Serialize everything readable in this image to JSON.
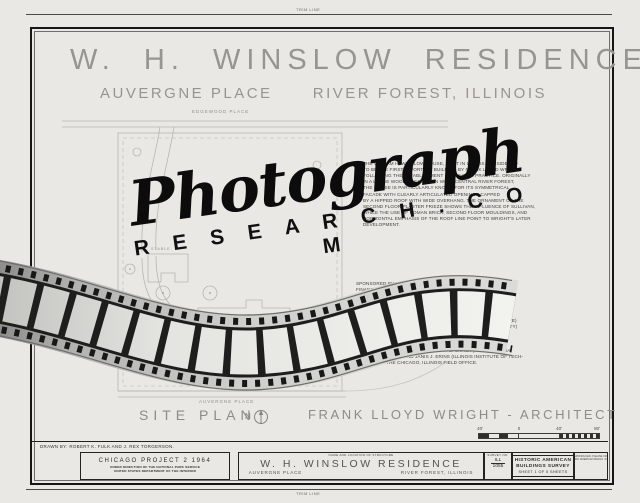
{
  "trim": {
    "top_label": "TRIM LINE",
    "bottom_label": "TRIM LINE"
  },
  "title": {
    "main": "W. H. WINSLOW RESIDENCE",
    "sub_left": "AUVERGNE PLACE",
    "sub_right": "RIVER FOREST, ILLINOIS"
  },
  "plan": {
    "street_top": "EDGEWOOD PLACE",
    "street_bottom": "AUVERGNE PLACE",
    "stable_label": "STABLE"
  },
  "paragraphs": {
    "history": "THE WILLIAM H. WINSLOW HOUSE, BUILT IN 1893, IS CONSIDERED\nTO BE THE FIRST IMPORTANT BUILDING BY FRANK LLOYD WRIGHT\nFOLLOWING THE ESTABLISHMENT OF HIS OWN PRACTICE. ORIGINALLY\nIN A LARGE WOODED ESTATE IN WEST CENTRAL RIVER FOREST,\nTHE HOUSE IS PARTICULARLY KNOWN FOR ITS SYMMETRICAL\nFACADE WITH CLEARLY ARTICULATED OPENINGS CAPPED\nBY A HIPPED ROOF WITH WIDE OVERHANG. THE ORNAMENT OF THE\nSECOND FLOOR PLASTER FRIEZE SHOWS THE INFLUENCE OF SULLIVAN,\nWHILE THE USE OF ROMAN BRICK, SECOND FLOOR MOULDINGS, AND\nHORIZONTAL EMPHASIS OF THE ROOF LINE POINT TO WRIGHT'S LATER\nDEVELOPMENT.",
    "credits": "SPONSORED BY THE NATIONAL PARK SERVICE, THE PROJECT WAS\nFINANCED FROM THE FUNDS OF THE \"MISSION 66\" PROGRAM\nOF THE NATIONAL PARK SERVICE AND FROM FUNDS LOCALLY DO-\nNATED. IT WAS MEASURED AND DRAWN DURING THE SUMMER OF\n1964 UNDER THE DIRECTION OF JAMES C. MASSEY, H.A.B.S.\nSUPERVISORY ARCHITECT, AND EARL H. REED, F.A.I.A., PROJECT\nSPONSOR, BY J. WILLIAM RUDD (TEXAS TECHNOLOGICAL COLLEGE)\nPROJECT SUPERVISOR, LARRY J. HOMOLKA (HARVARD UNIVERSITY)\nHISTORIAN, AND STUDENT ASSISTANT ARCHITECTS:  ROBERT K.\nFULK (UNIVERSITY OF PENNSYLVANIA), JOSEPH M. HAYMAN (\nUNIVERSITY OF PENNSYLVANIA), J. REX TORGERSON (ILLINOIS\nINSTITUTE OF TECHNOLOGY),   ROBERT S. SNACK (PENNSYLVANIA\nSTATE UNIVERSITY) AND JANIS J. ERINS (ILLINOIS INSTITUTE OF TECH-\nNOLOGY) AT THE CHICAGO, ILLINOIS FIELD OFFICE."
  },
  "watermark": {
    "script": "Photograph",
    "caps": "R E S E A R C H . C O M"
  },
  "caption": {
    "site_plan": "SITE PLAN",
    "north_letter": "N",
    "architect": "FRANK LLOYD WRIGHT - ARCHITECT"
  },
  "scale_bar": {
    "labels": [
      "40'",
      "0",
      "40'",
      "80'"
    ]
  },
  "title_block": {
    "drawn_by": "DRAWN BY: ROBERT K. FULK AND J. REX TORGERSON.",
    "project": {
      "line1": "CHICAGO PROJECT 2 1964",
      "line2": "UNDER DIRECTION OF THE NATIONAL PARK SERVICE",
      "line3": "UNITED STATES DEPARTMENT OF THE INTERIOR"
    },
    "name_box": {
      "header": "NAME AND LOCATION OF STRUCTURE",
      "name": "W. H. WINSLOW RESIDENCE",
      "address_left": "AUVERGNE PLACE",
      "address_right": "RIVER FOREST, ILLINOIS"
    },
    "survey": {
      "header": "SURVEY NO.",
      "state": "ILL",
      "number": "1055"
    },
    "habs": {
      "line1": "HISTORIC AMERICAN",
      "line2": "BUILDINGS SURVEY",
      "sheet_line": "SHEET 1 OF 5 SHEETS"
    },
    "credit_note": {
      "line1": "IF REPRODUCED, PLEASE CREDIT",
      "line2": "HISTORIC AMERICAN BLDGS. SURVEY"
    }
  },
  "colors": {
    "paper": "#eae8e4",
    "border_ink": "#161614",
    "drawing_line": "#b7b6b0",
    "faded_text": "#97958f",
    "watermark_ink": "#0c0c0c"
  }
}
